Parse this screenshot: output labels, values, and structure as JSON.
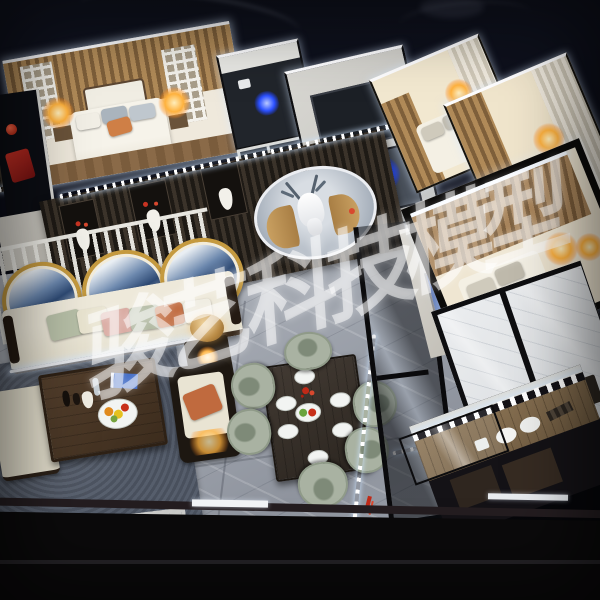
{
  "watermark": {
    "text": "骏艺科技模型",
    "characters": [
      "骏",
      "艺",
      "科",
      "技",
      "模",
      "型"
    ],
    "color": "#ffffff",
    "opacity": 0.52,
    "rotation_deg": -18
  },
  "palette": {
    "backdrop": "#0b0d18",
    "led_white": "#f6faff",
    "warm_lamp": "#ffb23e",
    "blue_accent": "#2b50ff",
    "marble_floor": "#a2a7b0",
    "rug_gray": "#59606e",
    "wood_dark": "#3b332a",
    "wood_warm": "#8a6a45",
    "sofa_cream": "#e9e4d3",
    "chair_sage": "#a9b2a2",
    "pillow_terracotta": "#c06a3e",
    "mirror_gold": "#c59a3f",
    "fascia_black": "#0b0a0b"
  }
}
